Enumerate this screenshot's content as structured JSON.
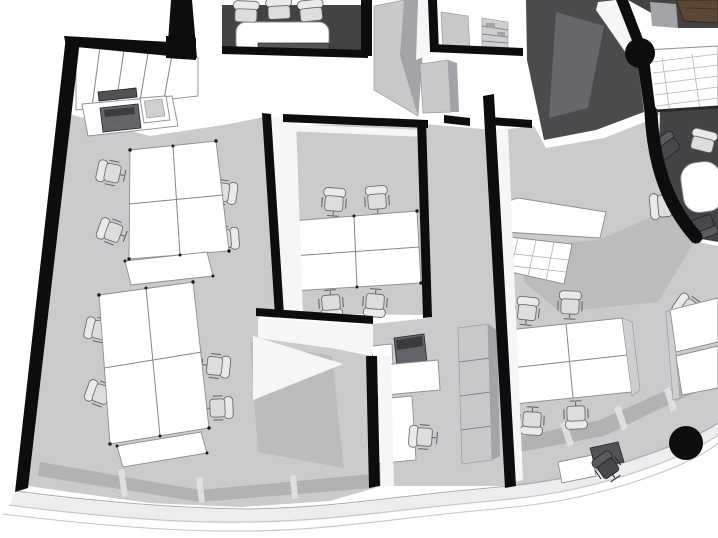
{
  "scene": {
    "kind": "monochrome-3d-axonometric-office-floor-plan-render",
    "crop": "building cut by image top edge; curved glass facade along bottom edge",
    "colors": {
      "bg": "#ffffff",
      "floor": "#cbcbce",
      "shadow": "#a6a6aa",
      "slit": "#e2e2e5",
      "wall_black": "#0d0d0f",
      "slab_light": "#c9c9cc",
      "slab_mid": "#a4a4a8",
      "charcoal": "#4b4b4e",
      "charcoal_light": "#67676b",
      "carpet": "#434346",
      "furniture_white": "#ffffff",
      "furniture_outline": "#8e8e92",
      "chair_fill": "#e9ebea",
      "chair_seat": "#dcdedd",
      "chair_stroke": "#5f5f63",
      "wood": "#5b4737",
      "panel": "#cfcfd2",
      "white_face": "#f6f6f8",
      "glass_line": "#c2c2c6",
      "facade_band": "#ededf0",
      "facade_line": "#c6c6c9",
      "dot": "#1a1a1a"
    },
    "rooms": [
      {
        "id": "open-office-west",
        "furniture": [
          "desk-cluster-2x2",
          "desk-cluster-2x2",
          "side-table",
          "side-table",
          "task-chair x8"
        ]
      },
      {
        "id": "private-office-center",
        "furniture": [
          "desk-cluster-2x2",
          "task-chair x4"
        ]
      },
      {
        "id": "conference-room-north",
        "floor": "dark-carpet",
        "furniture": [
          "conference-table",
          "conference-chair x3",
          "credenza"
        ]
      },
      {
        "id": "storage-room-north",
        "furniture": [
          "shelving-unit",
          "side-cabinet"
        ]
      },
      {
        "id": "copy-area-northwest",
        "furniture": [
          "wall-cabinets",
          "counter",
          "printer",
          "open-bin"
        ]
      },
      {
        "id": "meeting-room-northeast",
        "floor": "dark-carpet",
        "furniture": [
          "wood-table",
          "sideboard"
        ]
      },
      {
        "id": "meeting-room-east-rounded",
        "floor": "dark-carpet",
        "furniture": [
          "round-table",
          "conference-chair x4"
        ]
      },
      {
        "id": "open-office-east",
        "furniture": [
          "bench-desk-cluster-2x2",
          "task-chair x4",
          "corner-desk-row",
          "task-chair x2",
          "counter-row",
          "glass-floor-panels",
          "side-desk",
          "dark-task-chair"
        ]
      },
      {
        "id": "print-station-south",
        "furniture": [
          "cabinet",
          "printer",
          "counter",
          "desk",
          "task-chair"
        ]
      }
    ],
    "structure": [
      "black-partition-walls",
      "round-column x2",
      "tiled-pier",
      "curved-glass-facade",
      "glass-skylight-floor-ne"
    ]
  }
}
